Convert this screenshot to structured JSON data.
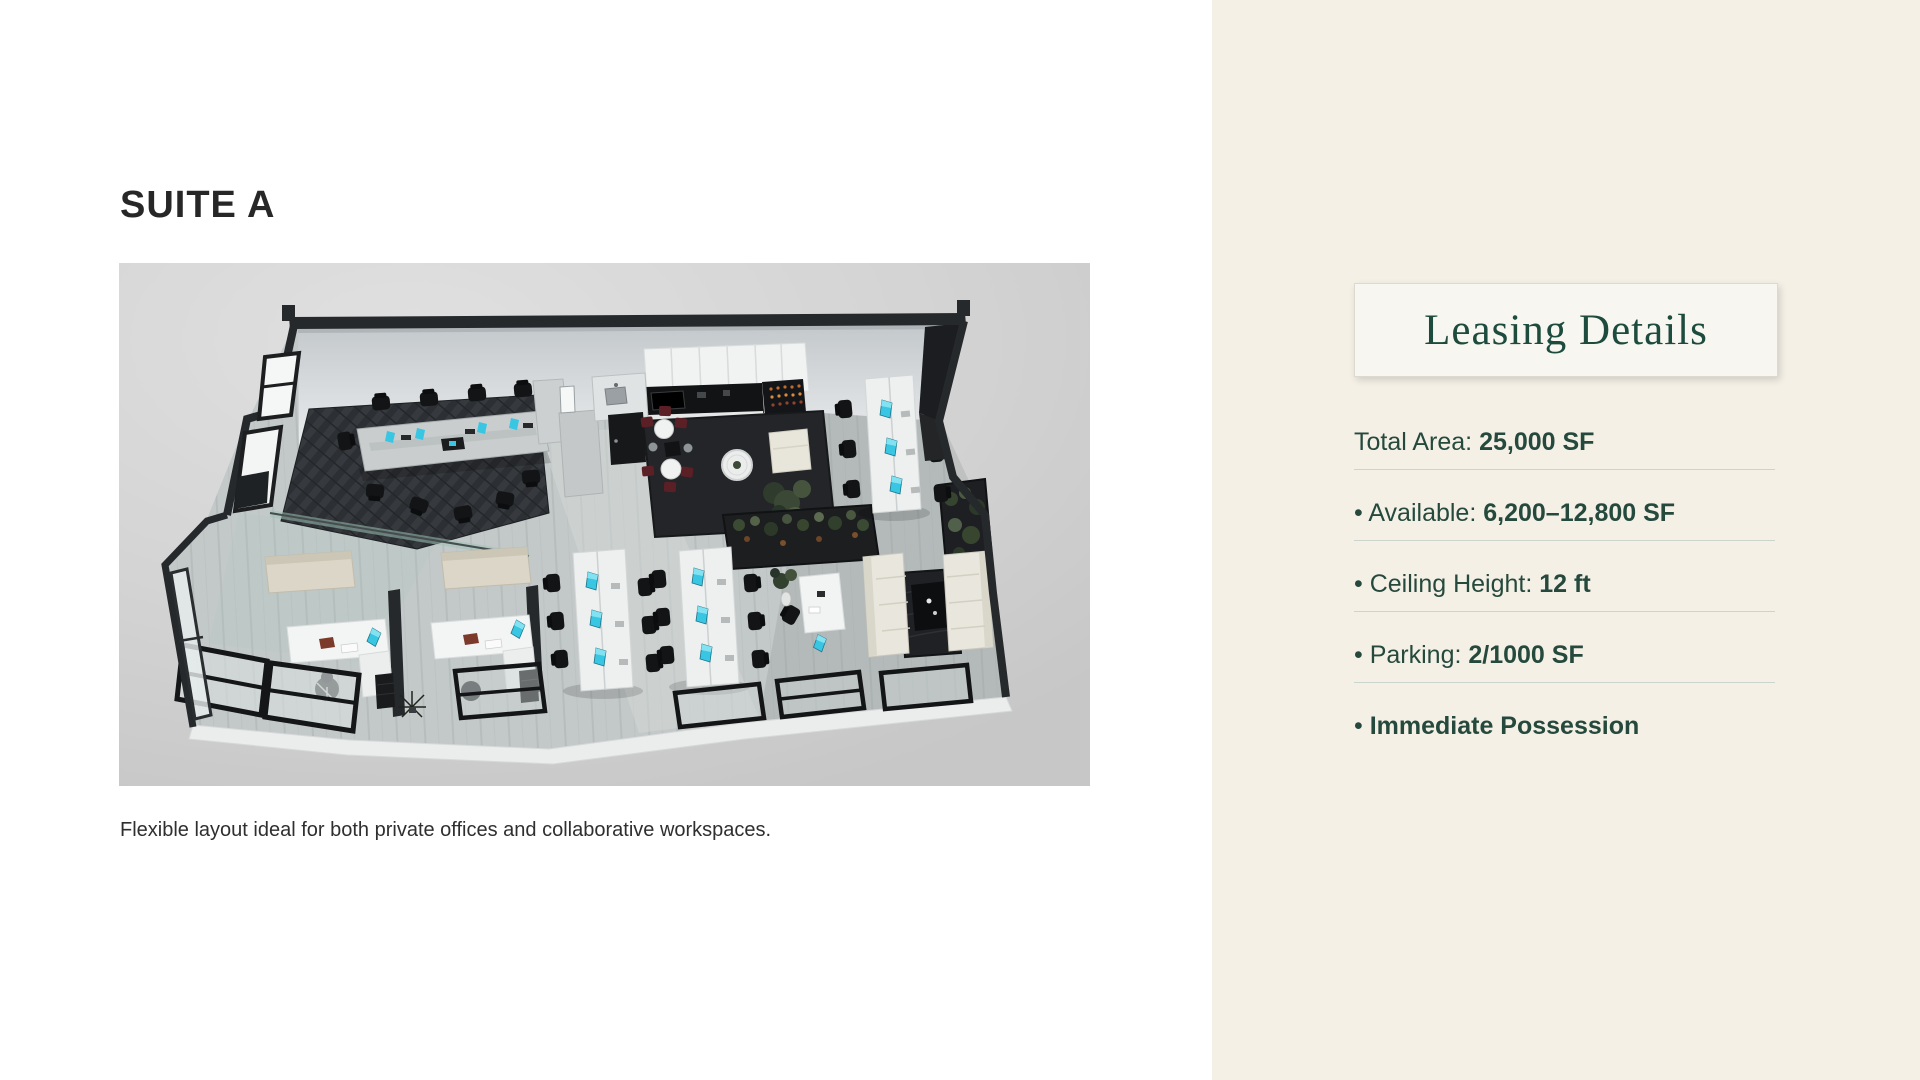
{
  "suite": {
    "title": "SUITE A",
    "caption": "Flexible layout ideal for both private offices and collaborative workspaces."
  },
  "leasing": {
    "title": "Leasing Details",
    "items": [
      {
        "bullet": "",
        "label": "Total Area: ",
        "value": "25,000 SF"
      },
      {
        "bullet": "• ",
        "label": "Available: ",
        "value": "6,200–12,800 SF"
      },
      {
        "bullet": "• ",
        "label": "Ceiling Height: ",
        "value": "12 ft"
      },
      {
        "bullet": "• ",
        "label": "Parking: ",
        "value": "2/1000 SF"
      },
      {
        "bullet": "• ",
        "label": "",
        "value": "Immediate Possession"
      }
    ]
  },
  "colors": {
    "sidebar_background": "#f4f0e6",
    "card_background": "#f8f6f0",
    "accent_green": "#1d4b3e",
    "text_green": "#26493d",
    "divider": "#ccd5cd",
    "heading_text": "#272727",
    "screen_teal": "#38c6e3"
  }
}
